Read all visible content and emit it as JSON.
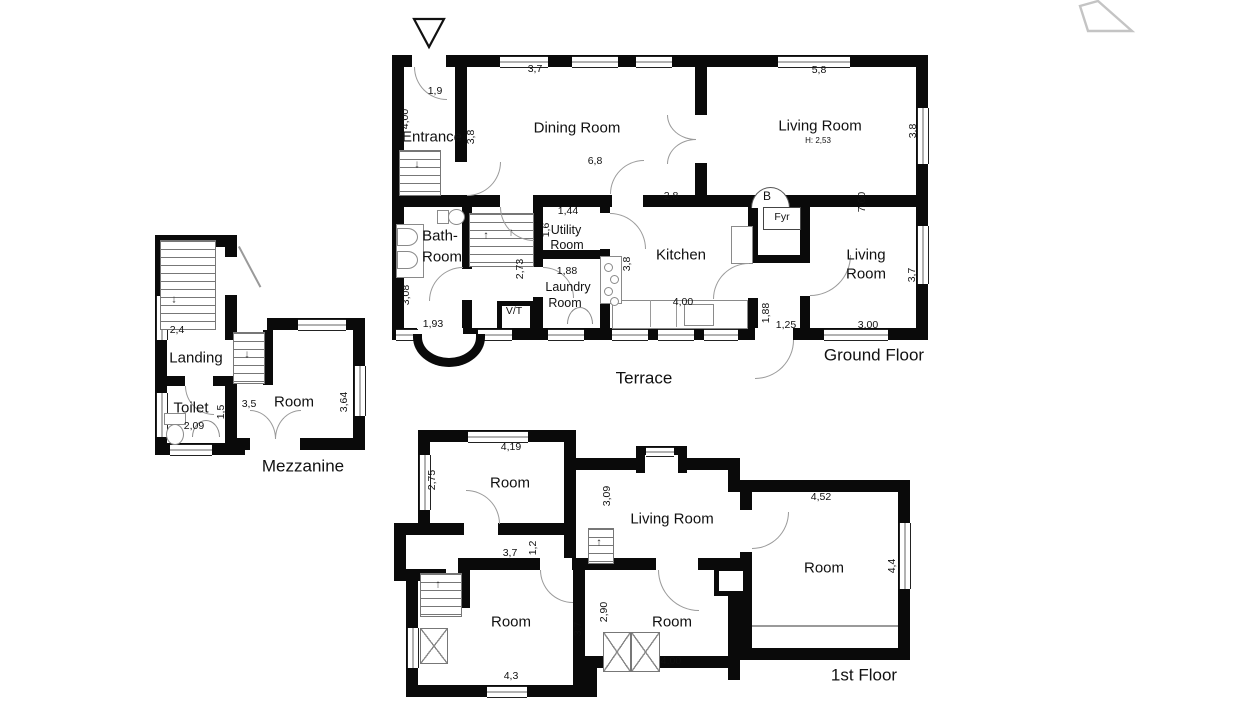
{
  "document": {
    "type": "architectural-floor-plan",
    "background": "#ffffff",
    "wall_color": "#0a0a0a",
    "line_color": "#9a9a9a",
    "text_color": "#111111"
  },
  "floors": [
    {
      "id": "ground-floor",
      "title": "Ground Floor",
      "labels": [
        {
          "t": "1,9",
          "x": 435,
          "y": 91,
          "c": "dim"
        },
        {
          "t": "4,00",
          "x": 405,
          "y": 119,
          "r": 1,
          "c": "dim"
        },
        {
          "t": "Entrance",
          "x": 432,
          "y": 137,
          "c": "room"
        },
        {
          "t": "3,8",
          "x": 471,
          "y": 137,
          "r": 1,
          "c": "dim"
        },
        {
          "t": "3,7",
          "x": 535,
          "y": 69,
          "c": "dim"
        },
        {
          "t": "Dining Room",
          "x": 577,
          "y": 128,
          "c": "room"
        },
        {
          "t": "6,8",
          "x": 595,
          "y": 161,
          "c": "dim"
        },
        {
          "t": "2,8",
          "x": 671,
          "y": 196,
          "c": "dim"
        },
        {
          "t": "5,8",
          "x": 819,
          "y": 70,
          "c": "dim"
        },
        {
          "t": "Living Room",
          "x": 820,
          "y": 126,
          "c": "room"
        },
        {
          "t": "H: 2,53",
          "x": 818,
          "y": 141,
          "c": "dimxs"
        },
        {
          "t": "3,8",
          "x": 913,
          "y": 131,
          "r": 1,
          "c": "dim"
        },
        {
          "t": "7,60",
          "x": 862,
          "y": 202,
          "r": 1,
          "c": "dim"
        },
        {
          "t": "B",
          "x": 767,
          "y": 196,
          "c": "b"
        },
        {
          "t": "Fyr",
          "x": 782,
          "y": 217,
          "c": "dim"
        },
        {
          "t": "1,44",
          "x": 568,
          "y": 211,
          "c": "dim"
        },
        {
          "t": "Utility",
          "x": 566,
          "y": 230,
          "c": "room-sm"
        },
        {
          "t": "Room",
          "x": 567,
          "y": 245,
          "c": "room-sm"
        },
        {
          "t": "1,6",
          "x": 546,
          "y": 230,
          "r": 1,
          "c": "dim"
        },
        {
          "t": "Bath-",
          "x": 440,
          "y": 236,
          "c": "room"
        },
        {
          "t": "Room",
          "x": 442,
          "y": 257,
          "c": "room"
        },
        {
          "t": "2,73",
          "x": 520,
          "y": 269,
          "r": 1,
          "c": "dim"
        },
        {
          "t": "1,88",
          "x": 567,
          "y": 271,
          "c": "dim"
        },
        {
          "t": "Laundry",
          "x": 568,
          "y": 287,
          "c": "room-sm"
        },
        {
          "t": "Room",
          "x": 565,
          "y": 303,
          "c": "room-sm"
        },
        {
          "t": "Kitchen",
          "x": 681,
          "y": 255,
          "c": "room"
        },
        {
          "t": "3,8",
          "x": 627,
          "y": 264,
          "r": 1,
          "c": "dim"
        },
        {
          "t": "Living",
          "x": 866,
          "y": 255,
          "c": "room"
        },
        {
          "t": "Room",
          "x": 866,
          "y": 274,
          "c": "room"
        },
        {
          "t": "3,08",
          "x": 406,
          "y": 295,
          "r": 1,
          "c": "dim"
        },
        {
          "t": "1,93",
          "x": 433,
          "y": 324,
          "c": "dim"
        },
        {
          "t": "V/T",
          "x": 514,
          "y": 311,
          "c": "dim"
        },
        {
          "t": "4,00",
          "x": 683,
          "y": 302,
          "c": "dim"
        },
        {
          "t": "1,88",
          "x": 766,
          "y": 313,
          "r": 1,
          "c": "dim"
        },
        {
          "t": "1,25",
          "x": 786,
          "y": 325,
          "c": "dim"
        },
        {
          "t": "3,00",
          "x": 868,
          "y": 325,
          "c": "dim"
        },
        {
          "t": "3,7",
          "x": 912,
          "y": 275,
          "r": 1,
          "c": "dim"
        },
        {
          "t": "Ground Floor",
          "x": 874,
          "y": 355,
          "c": "title"
        },
        {
          "t": "Terrace",
          "x": 644,
          "y": 378,
          "c": "title"
        }
      ]
    },
    {
      "id": "mezzanine",
      "title": "Mezzanine",
      "labels": [
        {
          "t": "2,4",
          "x": 177,
          "y": 330,
          "c": "dim"
        },
        {
          "t": "Landing",
          "x": 196,
          "y": 358,
          "c": "room"
        },
        {
          "t": "Toilet",
          "x": 191,
          "y": 408,
          "c": "room"
        },
        {
          "t": "2,09",
          "x": 194,
          "y": 426,
          "c": "dim"
        },
        {
          "t": "1,5",
          "x": 221,
          "y": 412,
          "r": 1,
          "c": "dim"
        },
        {
          "t": "3,5",
          "x": 249,
          "y": 404,
          "c": "dim"
        },
        {
          "t": "Room",
          "x": 294,
          "y": 402,
          "c": "room"
        },
        {
          "t": "3,64",
          "x": 344,
          "y": 402,
          "r": 1,
          "c": "dim"
        },
        {
          "t": "Mezzanine",
          "x": 303,
          "y": 466,
          "c": "title"
        }
      ]
    },
    {
      "id": "first-floor",
      "title": "1st Floor",
      "labels": [
        {
          "t": "4,19",
          "x": 511,
          "y": 447,
          "c": "dim"
        },
        {
          "t": "2,75",
          "x": 432,
          "y": 480,
          "r": 1,
          "c": "dim"
        },
        {
          "t": "Room",
          "x": 510,
          "y": 483,
          "c": "room"
        },
        {
          "t": "3,09",
          "x": 607,
          "y": 496,
          "r": 1,
          "c": "dim"
        },
        {
          "t": "Living Room",
          "x": 672,
          "y": 519,
          "c": "room"
        },
        {
          "t": "1,2",
          "x": 533,
          "y": 548,
          "r": 1,
          "c": "dim"
        },
        {
          "t": "3,7",
          "x": 510,
          "y": 553,
          "c": "dim"
        },
        {
          "t": "4,52",
          "x": 821,
          "y": 497,
          "c": "dim"
        },
        {
          "t": "Room",
          "x": 824,
          "y": 568,
          "c": "room"
        },
        {
          "t": "4,4",
          "x": 892,
          "y": 566,
          "r": 1,
          "c": "dim"
        },
        {
          "t": "Room",
          "x": 511,
          "y": 622,
          "c": "room"
        },
        {
          "t": "3,7",
          "x": 578,
          "y": 629,
          "r": 1,
          "c": "dim"
        },
        {
          "t": "2,90",
          "x": 604,
          "y": 612,
          "r": 1,
          "c": "dim"
        },
        {
          "t": "Room",
          "x": 672,
          "y": 622,
          "c": "room"
        },
        {
          "t": "4.00",
          "x": 671,
          "y": 661,
          "c": "dim"
        },
        {
          "t": "4,3",
          "x": 511,
          "y": 676,
          "c": "dim"
        },
        {
          "t": "1st Floor",
          "x": 864,
          "y": 675,
          "c": "title"
        }
      ]
    }
  ],
  "icons": {
    "north_arrow": "north-arrow-icon",
    "site_outline": "site-outline-icon",
    "freezer_glyph": "❄"
  }
}
